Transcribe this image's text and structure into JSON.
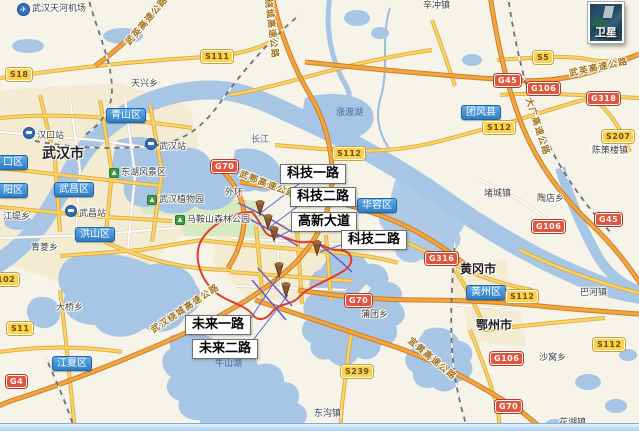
{
  "map": {
    "satellite_button": {
      "label": "卫星"
    },
    "airport": {
      "label": "武汉天河机场",
      "x": 17,
      "y": 3,
      "icon": "airplane",
      "ix": 4,
      "iy": 3
    },
    "cities": [
      {
        "label": "武汉市",
        "x": 42,
        "y": 147,
        "size": 14
      },
      {
        "label": "黄冈市",
        "x": 460,
        "y": 263,
        "size": 12
      },
      {
        "label": "鄂州市",
        "x": 476,
        "y": 319,
        "size": 12
      }
    ],
    "districts": [
      {
        "label": "青山区",
        "x": 106,
        "y": 108
      },
      {
        "label": "武昌区",
        "x": 54,
        "y": 182
      },
      {
        "label": "洪山区",
        "x": 75,
        "y": 227
      },
      {
        "label": "江夏区",
        "x": 52,
        "y": 356
      },
      {
        "label": "团风县",
        "x": 461,
        "y": 105
      },
      {
        "label": "华容区",
        "x": 357,
        "y": 198
      },
      {
        "label": "黄州区",
        "x": 466,
        "y": 285
      },
      {
        "label": "口区",
        "x": -2,
        "y": 155
      },
      {
        "label": "阳区",
        "x": -2,
        "y": 183
      }
    ],
    "towns": [
      {
        "label": "天兴乡",
        "x": 131,
        "y": 80
      },
      {
        "label": "辛冲镇",
        "x": 423,
        "y": 2
      },
      {
        "label": "江堤乡",
        "x": 3,
        "y": 213
      },
      {
        "label": "青菱乡",
        "x": 31,
        "y": 244
      },
      {
        "label": "大桥乡",
        "x": 56,
        "y": 304
      },
      {
        "label": "外环",
        "x": 225,
        "y": 189
      },
      {
        "label": "堵城镇",
        "x": 484,
        "y": 190
      },
      {
        "label": "陶店乡",
        "x": 537,
        "y": 195
      },
      {
        "label": "陈策楼镇",
        "x": 592,
        "y": 147
      },
      {
        "label": "巴河镇",
        "x": 580,
        "y": 289
      },
      {
        "label": "沙窝乡",
        "x": 539,
        "y": 354
      },
      {
        "label": "蒲团乡",
        "x": 361,
        "y": 311
      },
      {
        "label": "东沟镇",
        "x": 314,
        "y": 410
      },
      {
        "label": "花湖镇",
        "x": 559,
        "y": 419
      }
    ],
    "waters": [
      {
        "label": "长江",
        "x": 251,
        "y": 136
      },
      {
        "label": "涨渡湖",
        "x": 336,
        "y": 109
      },
      {
        "label": "牛山湖",
        "x": 215,
        "y": 360
      }
    ],
    "pois": [
      {
        "label": "东湖风景区",
        "x": 109,
        "y": 168
      },
      {
        "label": "武汉植物园",
        "x": 147,
        "y": 195
      },
      {
        "label": "马鞍山森林公园",
        "x": 175,
        "y": 215
      }
    ],
    "stations": [
      {
        "label": "汉口站",
        "x": 23,
        "y": 127
      },
      {
        "label": "武汉站",
        "x": 145,
        "y": 138
      },
      {
        "label": "武昌站",
        "x": 65,
        "y": 205
      }
    ],
    "shields_s": [
      {
        "label": "S18",
        "x": 6,
        "y": 68
      },
      {
        "label": "S111",
        "x": 201,
        "y": 50
      },
      {
        "label": "S5",
        "x": 533,
        "y": 51
      },
      {
        "label": "S112",
        "x": 483,
        "y": 121
      },
      {
        "label": "S112",
        "x": 333,
        "y": 147
      },
      {
        "label": "S112",
        "x": 506,
        "y": 290
      },
      {
        "label": "S112",
        "x": 593,
        "y": 338
      },
      {
        "label": "S207",
        "x": 602,
        "y": 130
      },
      {
        "label": "S11",
        "x": 7,
        "y": 322
      },
      {
        "label": "S239",
        "x": 341,
        "y": 365
      },
      {
        "label": "102",
        "x": -7,
        "y": 273
      }
    ],
    "shields_g": [
      {
        "label": "G70",
        "x": 211,
        "y": 160
      },
      {
        "label": "G70",
        "x": 345,
        "y": 294
      },
      {
        "label": "G70",
        "x": 495,
        "y": 400
      },
      {
        "label": "G45",
        "x": 494,
        "y": 74
      },
      {
        "label": "G45",
        "x": 595,
        "y": 213
      },
      {
        "label": "G106",
        "x": 527,
        "y": 82
      },
      {
        "label": "G106",
        "x": 532,
        "y": 220
      },
      {
        "label": "G106",
        "x": 490,
        "y": 352
      },
      {
        "label": "G318",
        "x": 587,
        "y": 92
      },
      {
        "label": "G316",
        "x": 425,
        "y": 252
      },
      {
        "label": "G4",
        "x": 6,
        "y": 375
      }
    ],
    "expressways": [
      {
        "label": "武英高速公路",
        "cx": 148,
        "cy": 22,
        "rotate": -50
      },
      {
        "label": "武英高速公路",
        "cx": 599,
        "cy": 69,
        "rotate": -12
      },
      {
        "label": "绕城高速公路",
        "cx": 270,
        "cy": 29,
        "rotate": 83
      },
      {
        "label": "大广高速公路",
        "cx": 536,
        "cy": 127,
        "rotate": 72
      },
      {
        "label": "武鄂高速公路",
        "cx": 267,
        "cy": 186,
        "rotate": 21
      },
      {
        "label": "武汉绕城高速公路",
        "cx": 186,
        "cy": 310,
        "rotate": -34
      },
      {
        "label": "宜黄高速公路",
        "cx": 431,
        "cy": 360,
        "rotate": 40
      }
    ],
    "callouts": [
      {
        "label": "科技一路",
        "x": 280,
        "y": 164
      },
      {
        "label": "科技二路",
        "x": 290,
        "y": 187
      },
      {
        "label": "高新大道",
        "x": 291,
        "y": 212
      },
      {
        "label": "科技二路",
        "x": 341,
        "y": 230
      },
      {
        "label": "未来一路",
        "x": 185,
        "y": 315
      },
      {
        "label": "未来二路",
        "x": 192,
        "y": 339
      }
    ],
    "colors": {
      "land": "#f6f3e8",
      "water": "#a7c5e5",
      "urban": "#f3ecd2",
      "park": "#d8e8c0",
      "road_yellow": "#fbd263",
      "road_orange": "#f2a63f",
      "shield_g_bg": "#e2543c",
      "shield_s_bg": "#fdd14b",
      "district_pill": "#2e7cc4",
      "route_highlight": "#e23b2e",
      "leader_line": "#5a54c8",
      "marker_brown": "#8a5530"
    }
  }
}
